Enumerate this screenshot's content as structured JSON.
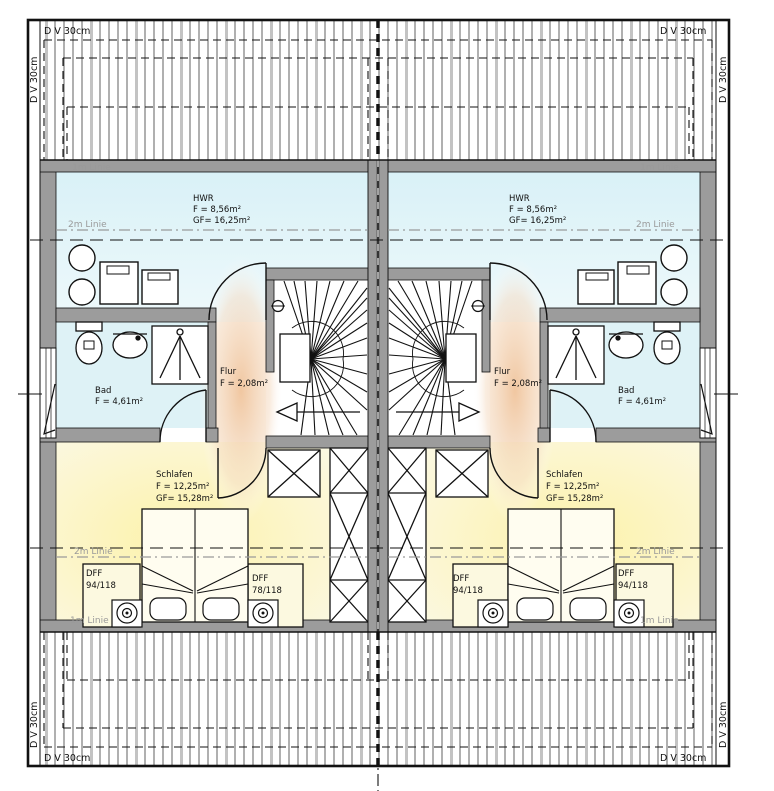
{
  "drawing_title": "Dachgeschoss Grundriss Doppelhaus",
  "edge_label": "D V 30cm",
  "guides": {
    "one_m": "1m Linie",
    "two_m": "2m Linie"
  },
  "units": {
    "left": {
      "hwr": {
        "name": "HWR",
        "area": "F = 8,56m²",
        "gross": "GF= 16,25m²"
      },
      "flur": {
        "name": "Flur",
        "area": "F = 2,08m²"
      },
      "bad": {
        "name": "Bad",
        "area": "F = 4,61m²"
      },
      "schlafen": {
        "name": "Schlafen",
        "area": "F = 12,25m²",
        "gross": "GF= 15,28m²"
      },
      "roof_window_outer": {
        "label": "DFF",
        "size": "94/118"
      },
      "roof_window_inner": {
        "label": "DFF",
        "size": "78/118"
      }
    },
    "right": {
      "hwr": {
        "name": "HWR",
        "area": "F = 8,56m²",
        "gross": "GF= 16,25m²"
      },
      "flur": {
        "name": "Flur",
        "area": "F = 2,08m²"
      },
      "bad": {
        "name": "Bad",
        "area": "F = 4,61m²"
      },
      "schlafen": {
        "name": "Schlafen",
        "area": "F = 12,25m²",
        "gross": "GF= 15,28m²"
      },
      "roof_window_inner": {
        "label": "DFF",
        "size": "94/118"
      },
      "roof_window_outer": {
        "label": "DFF",
        "size": "94/118"
      }
    }
  },
  "colors": {
    "wall_gray": "#9c9c9c",
    "hwr_tint": "#d9f1f7",
    "bad_tint": "#def2f6",
    "schlafen_tint": "#fdf2aa",
    "schlafen_edge": "#fbf8e2",
    "flur_warm": "#f0c49c",
    "guide_gray": "#9a9a9a"
  }
}
